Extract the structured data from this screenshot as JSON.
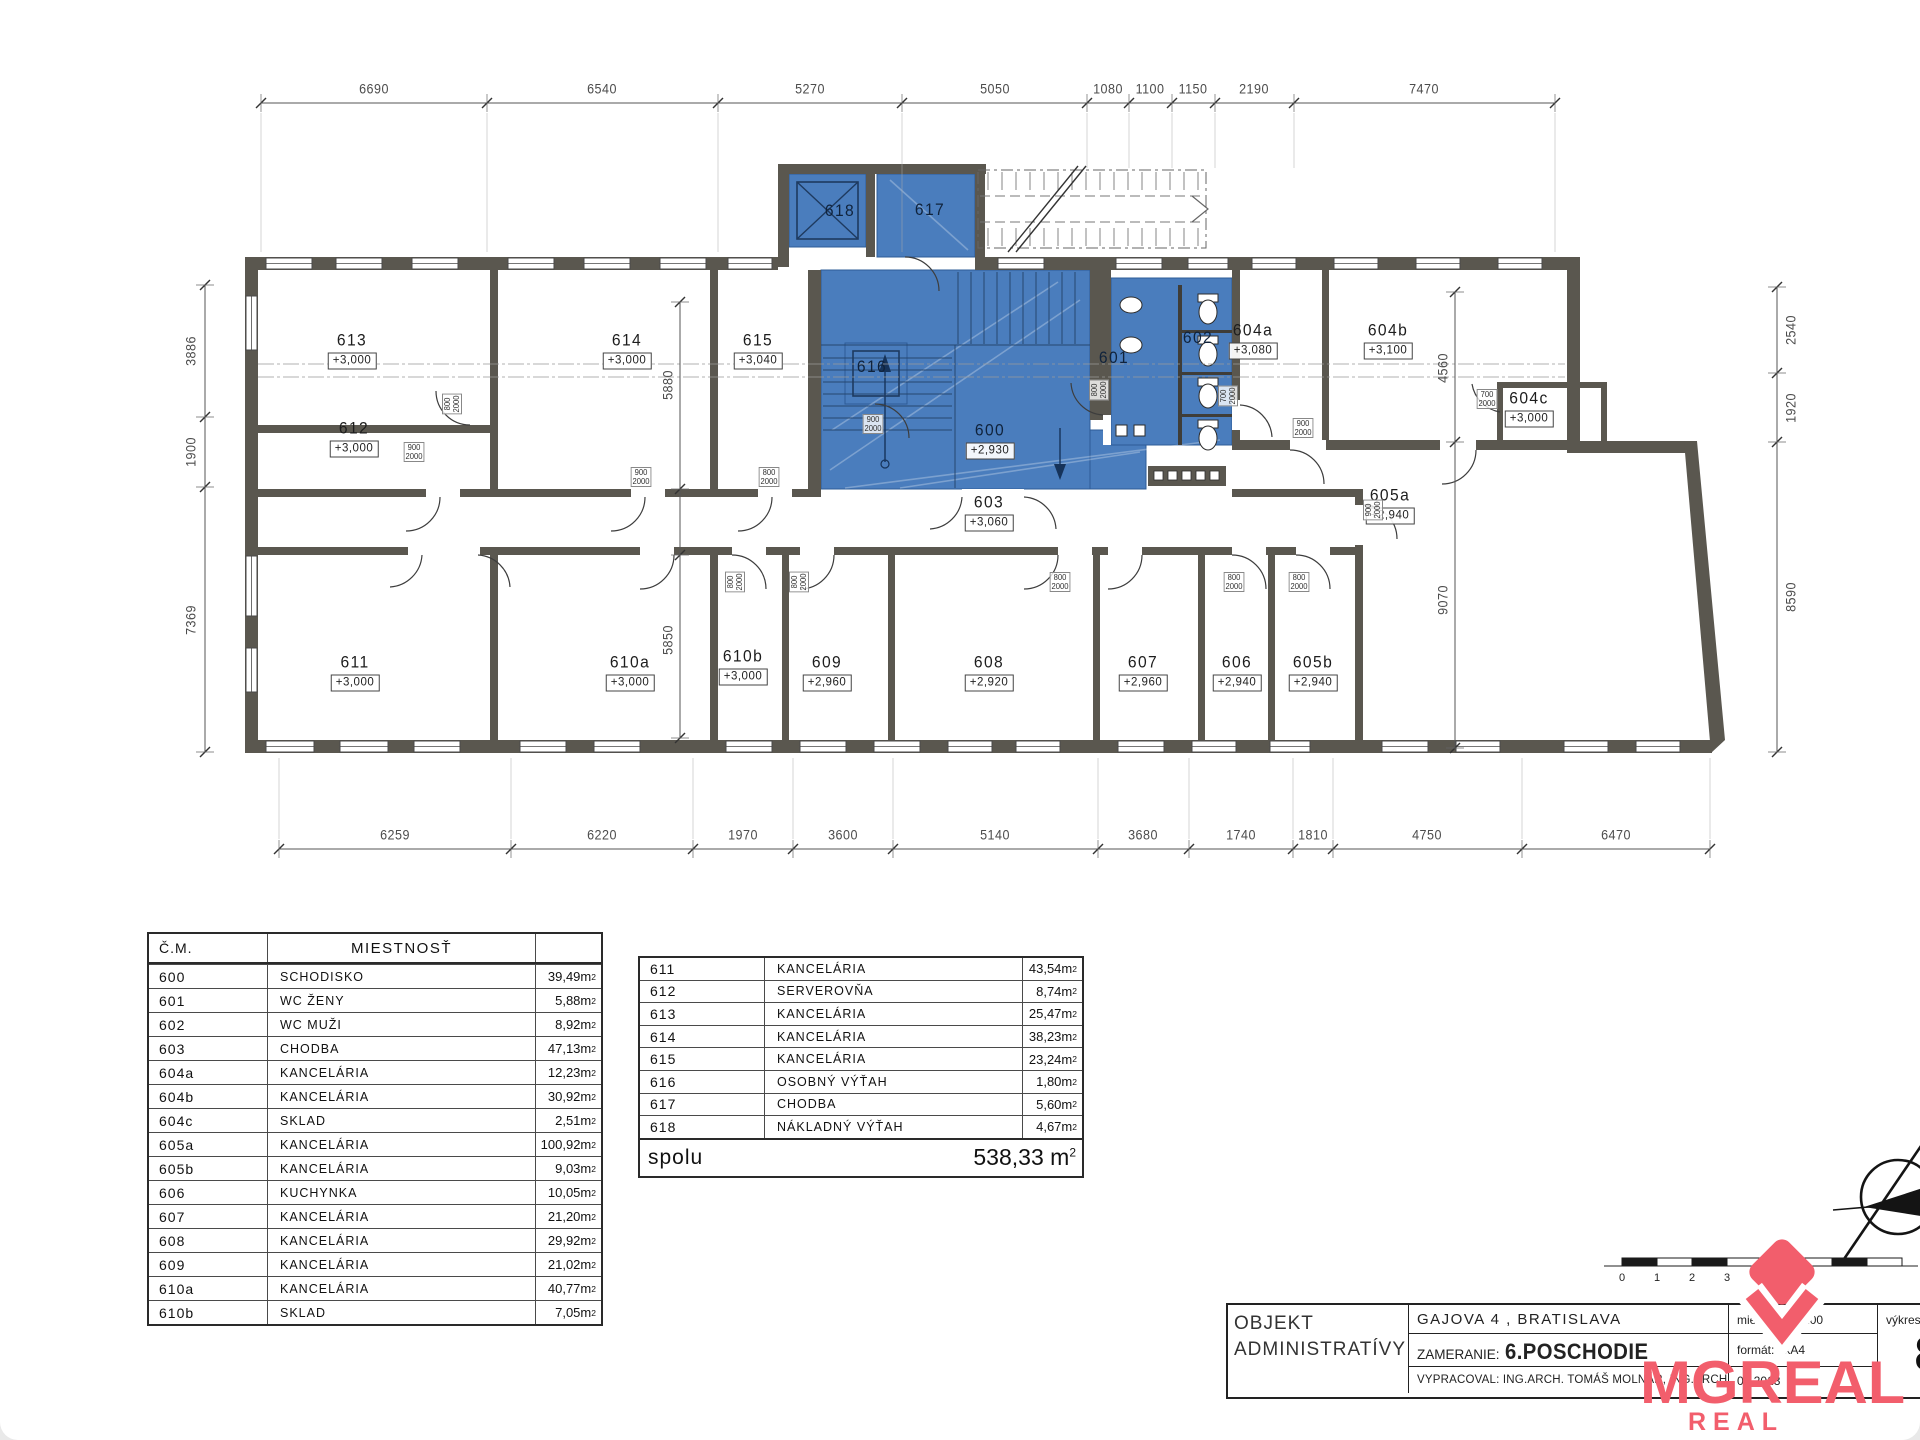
{
  "logo": {
    "brand": "MGREAL",
    "tagline": "REAL ESTATE",
    "color": "#f25e6c"
  },
  "scale_bar": {
    "labels": [
      "0",
      "1",
      "2",
      "3"
    ]
  },
  "title_block": {
    "object_line1": "OBJEKT",
    "object_line2": "ADMINISTRATÍVY",
    "address": "GAJOVA 4 , BRATISLAVA",
    "survey_label": "ZAMERANIE:",
    "survey_value": "6.POSCHODIE",
    "author_line": "VYPRACOVAL: ING.ARCH. TOMÁŠ MOLNÁR, ING.ARCH. MÁRIA DANKOVÁ",
    "date": "05.2013",
    "scale_label": "mierka:",
    "scale_value": "M 1:200",
    "format_label": "formát:",
    "format_value": "1xA4",
    "sheet_label": "výkres",
    "sheet_number": "8"
  },
  "tables": {
    "unit": "m²",
    "left": {
      "headers": [
        "Č.M.",
        "MIESTNOSŤ",
        ""
      ],
      "rows": [
        [
          "600",
          "SCHODISKO",
          "39,49"
        ],
        [
          "601",
          "WC ŽENY",
          "5,88"
        ],
        [
          "602",
          "WC MUŽI",
          "8,92"
        ],
        [
          "603",
          "CHODBA",
          "47,13"
        ],
        [
          "604a",
          "KANCELÁRIA",
          "12,23"
        ],
        [
          "604b",
          "KANCELÁRIA",
          "30,92"
        ],
        [
          "604c",
          "SKLAD",
          "2,51"
        ],
        [
          "605a",
          "KANCELÁRIA",
          "100,92"
        ],
        [
          "605b",
          "KANCELÁRIA",
          "9,03"
        ],
        [
          "606",
          "KUCHYNKA",
          "10,05"
        ],
        [
          "607",
          "KANCELÁRIA",
          "21,20"
        ],
        [
          "608",
          "KANCELÁRIA",
          "29,92"
        ],
        [
          "609",
          "KANCELÁRIA",
          "21,02"
        ],
        [
          "610a",
          "KANCELÁRIA",
          "40,77"
        ],
        [
          "610b",
          "SKLAD",
          "7,05"
        ]
      ]
    },
    "right": {
      "rows": [
        [
          "611",
          "KANCELÁRIA",
          "43,54"
        ],
        [
          "612",
          "SERVEROVŇA",
          "8,74"
        ],
        [
          "613",
          "KANCELÁRIA",
          "25,47"
        ],
        [
          "614",
          "KANCELÁRIA",
          "38,23"
        ],
        [
          "615",
          "KANCELÁRIA",
          "23,24"
        ],
        [
          "616",
          "OSOBNÝ VÝŤAH",
          "1,80"
        ],
        [
          "617",
          "CHODBA",
          "5,60"
        ],
        [
          "618",
          "NÁKLADNÝ VÝŤAH",
          "4,67"
        ]
      ],
      "total_label": "spolu",
      "total_value": "538,33"
    }
  },
  "plan": {
    "rooms": [
      {
        "num": "613",
        "level": "+3,000",
        "x": 352,
        "y": 350
      },
      {
        "num": "612",
        "level": "+3,000",
        "x": 354,
        "y": 438
      },
      {
        "num": "614",
        "level": "+3,000",
        "x": 627,
        "y": 350
      },
      {
        "num": "615",
        "level": "+3,040",
        "x": 758,
        "y": 350
      },
      {
        "num": "616",
        "level": "",
        "x": 872,
        "y": 367,
        "blue": 1
      },
      {
        "num": "617",
        "level": "",
        "x": 930,
        "y": 210,
        "blue": 1
      },
      {
        "num": "618",
        "level": "",
        "x": 840,
        "y": 211,
        "blue": 1
      },
      {
        "num": "600",
        "level": "+2,930",
        "x": 990,
        "y": 440,
        "blue": 1
      },
      {
        "num": "601",
        "level": "",
        "x": 1114,
        "y": 358,
        "blue": 1
      },
      {
        "num": "602",
        "level": "",
        "x": 1198,
        "y": 338,
        "blue": 1
      },
      {
        "num": "603",
        "level": "+3,060",
        "x": 989,
        "y": 512
      },
      {
        "num": "604a",
        "level": "+3,080",
        "x": 1253,
        "y": 340
      },
      {
        "num": "604b",
        "level": "+3,100",
        "x": 1388,
        "y": 340
      },
      {
        "num": "604c",
        "level": "+3,000",
        "x": 1529,
        "y": 408
      },
      {
        "num": "605a",
        "level": "+2,940",
        "x": 1390,
        "y": 505
      },
      {
        "num": "605b",
        "level": "+2,940",
        "x": 1313,
        "y": 672
      },
      {
        "num": "606",
        "level": "+2,940",
        "x": 1237,
        "y": 672
      },
      {
        "num": "607",
        "level": "+2,960",
        "x": 1143,
        "y": 672
      },
      {
        "num": "608",
        "level": "+2,920",
        "x": 989,
        "y": 672
      },
      {
        "num": "609",
        "level": "+2,960",
        "x": 827,
        "y": 672
      },
      {
        "num": "610a",
        "level": "+3,000",
        "x": 630,
        "y": 672
      },
      {
        "num": "610b",
        "level": "+3,000",
        "x": 743,
        "y": 666
      },
      {
        "num": "611",
        "level": "+3,000",
        "x": 355,
        "y": 672
      }
    ],
    "dims": {
      "top": [
        {
          "v": "6690",
          "x": 374
        },
        {
          "v": "6540",
          "x": 602
        },
        {
          "v": "5270",
          "x": 810
        },
        {
          "v": "5050",
          "x": 995
        },
        {
          "v": "1080",
          "x": 1108
        },
        {
          "v": "1100",
          "x": 1150
        },
        {
          "v": "1150",
          "x": 1193
        },
        {
          "v": "2190",
          "x": 1254
        },
        {
          "v": "7470",
          "x": 1424
        }
      ],
      "bottom": [
        {
          "v": "6259",
          "x": 395
        },
        {
          "v": "6220",
          "x": 602
        },
        {
          "v": "1970",
          "x": 743
        },
        {
          "v": "3600",
          "x": 843
        },
        {
          "v": "5140",
          "x": 995
        },
        {
          "v": "3680",
          "x": 1143
        },
        {
          "v": "1740",
          "x": 1241
        },
        {
          "v": "1810",
          "x": 1313
        },
        {
          "v": "4750",
          "x": 1427
        },
        {
          "v": "6470",
          "x": 1616
        }
      ],
      "left": [
        {
          "v": "3886",
          "y": 351
        },
        {
          "v": "1900",
          "y": 452
        },
        {
          "v": "7369",
          "y": 620
        }
      ],
      "right": [
        {
          "v": "2540",
          "y": 330
        },
        {
          "v": "1920",
          "y": 408
        },
        {
          "v": "8590",
          "y": 597
        }
      ],
      "inner_left": [
        {
          "v": "5880",
          "y": 385
        },
        {
          "v": "5850",
          "y": 640
        }
      ],
      "inner_right": [
        {
          "v": "4560",
          "y": 368
        },
        {
          "v": "9070",
          "y": 600
        }
      ]
    },
    "door_labels": [
      {
        "w": "800",
        "h": "2000",
        "x": 452,
        "y": 404,
        "rot": 1
      },
      {
        "w": "900",
        "h": "2000",
        "x": 414,
        "y": 452,
        "rot": 0
      },
      {
        "w": "900",
        "h": "2000",
        "x": 641,
        "y": 477,
        "rot": 0
      },
      {
        "w": "800",
        "h": "2000",
        "x": 769,
        "y": 477,
        "rot": 0
      },
      {
        "w": "900",
        "h": "2000",
        "x": 873,
        "y": 424,
        "rot": 0
      },
      {
        "w": "800",
        "h": "2000",
        "x": 1099,
        "y": 390,
        "rot": 1
      },
      {
        "w": "700",
        "h": "2000",
        "x": 1228,
        "y": 396,
        "rot": 1
      },
      {
        "w": "900",
        "h": "2000",
        "x": 1303,
        "y": 428,
        "rot": 0
      },
      {
        "w": "700",
        "h": "2000",
        "x": 1487,
        "y": 399,
        "rot": 0
      },
      {
        "w": "800",
        "h": "2000",
        "x": 735,
        "y": 582,
        "rot": 1
      },
      {
        "w": "800",
        "h": "2000",
        "x": 799,
        "y": 582,
        "rot": 1
      },
      {
        "w": "800",
        "h": "2000",
        "x": 1060,
        "y": 582,
        "rot": 0
      },
      {
        "w": "800",
        "h": "2000",
        "x": 1234,
        "y": 582,
        "rot": 0
      },
      {
        "w": "800",
        "h": "2000",
        "x": 1299,
        "y": 582,
        "rot": 0
      },
      {
        "w": "900",
        "h": "2000",
        "x": 1373,
        "y": 510,
        "rot": 1
      }
    ]
  }
}
